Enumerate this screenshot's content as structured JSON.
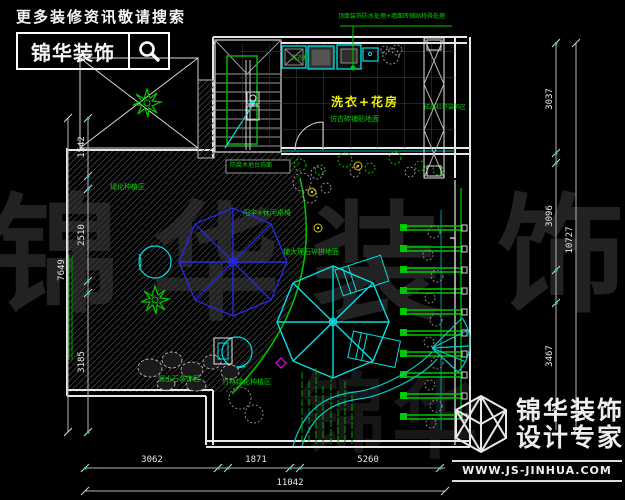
{
  "header": {
    "search_hint": "更多装修资讯敬请搜索",
    "brand": "锦华装饰"
  },
  "watermark": {
    "chars": [
      "锦",
      "华",
      "装",
      "饰"
    ],
    "chars2": [
      "锦",
      "华"
    ]
  },
  "plan": {
    "room_label": "洗衣+花房",
    "annotations": {
      "top_note": "顶面装饰防水处理+墙面砖铺贴特殊处理",
      "washer_note": "洗衣机",
      "floor_note": "仿古砖铺贴地面",
      "railing_note": "成品栏杆装饰区",
      "planting_note": "绿化种植区",
      "deck_note": "防腐木地台饰面",
      "umbrella_note": "阳伞+休闲桌椅",
      "marble_note": "铺大理石碎拼地面",
      "rock_note": "假山石装饰区",
      "bamboo_note": "竹林绿化种植区"
    }
  },
  "dimensions": {
    "left": {
      "segments": [
        "1542",
        "2510",
        "3185"
      ],
      "total": "7649"
    },
    "right": {
      "segments": [
        "3037",
        "3096",
        "3467"
      ],
      "total": "10727"
    },
    "bottom": {
      "segments": [
        "3062",
        "1871",
        "5260"
      ],
      "total": "11042"
    }
  },
  "logo": {
    "brand": "锦华装饰",
    "tagline": "设计专家",
    "website": "WWW.JS-JINHUA.COM"
  },
  "colors": {
    "wall": "#e6e6e6",
    "fixture": "#00e0e0",
    "landscape": "#00c800",
    "parasol_blue": "#2828e0",
    "label_yellow": "#f0f000",
    "accent_magenta": "#f000f0"
  }
}
